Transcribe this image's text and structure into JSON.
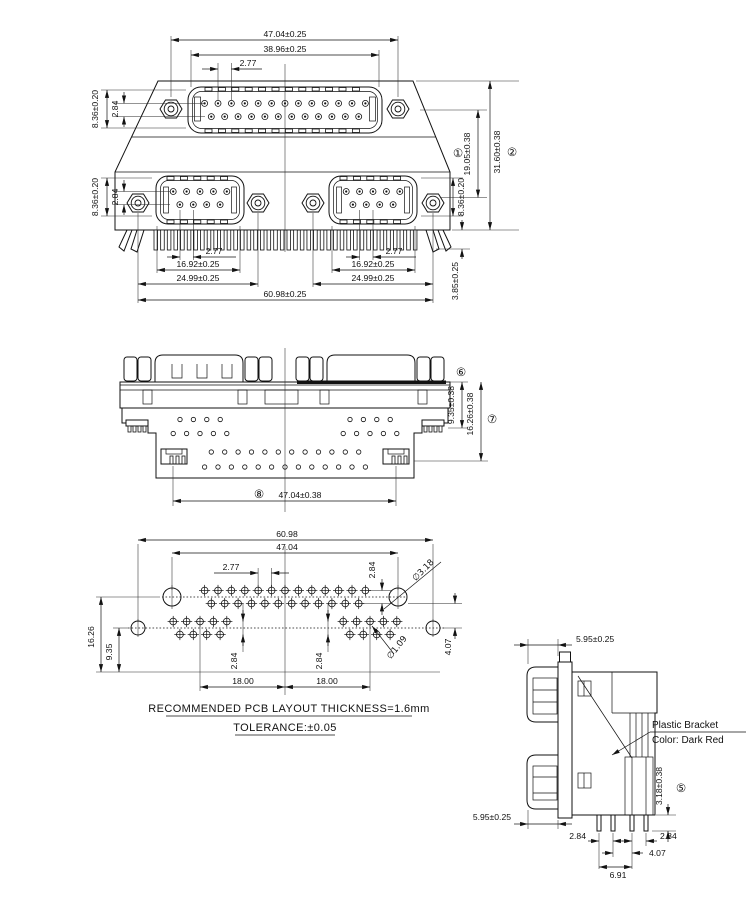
{
  "views": {
    "front": {
      "dims": {
        "w4704": "47.04±0.25",
        "w3896": "38.96±0.25",
        "p277": "2.77",
        "l836_top": "8.36±0.20",
        "l284_top": "2.84",
        "l836_bot": "8.36±0.20",
        "l284_bot": "2.84",
        "r836": "8.36±0.20",
        "c1": "①",
        "d1905": "19.05±0.38",
        "c2": "②",
        "d3160": "31.60±0.38",
        "d385": "3.85±0.25",
        "pl277": "2.77",
        "pl1692": "16.92±0.25",
        "pl2499": "24.99±0.25",
        "pr277": "2.77",
        "pr1692": "16.92±0.25",
        "pr2499": "24.99±0.25",
        "w6098": "60.98±0.25"
      }
    },
    "bottom": {
      "dims": {
        "c6": "⑥",
        "d935": "9.35±0.38",
        "d1626": "16.26±0.38",
        "c7": "⑦",
        "c8": "⑧",
        "d4704": "47.04±0.38"
      }
    },
    "pcb": {
      "dims": {
        "w6098": "60.98",
        "w4704": "47.04",
        "p277": "2.77",
        "d284_top": "2.84",
        "dia318": "∅3.18",
        "d1626": "16.26",
        "d935": "9.35",
        "d284_l": "2.84",
        "d284_r": "2.84",
        "dia109": "∅1.09",
        "d407": "4.07",
        "d18_l": "18.00",
        "d18_r": "18.00"
      },
      "note1": "RECOMMENDED PCB LAYOUT THICKNESS=1.6mm",
      "note2": "TOLERANCE:±0.05"
    },
    "side": {
      "dims": {
        "d595_top": "5.95±0.25",
        "d595_bot": "5.95±0.25",
        "d318": "3.18±0.38",
        "c5": "⑤",
        "d284_l": "2.84",
        "d284_r": "2.84",
        "d407": "4.07",
        "d691": "6.91"
      },
      "callout1": "Plastic Bracket",
      "callout2": "Color: Dark Red"
    }
  }
}
